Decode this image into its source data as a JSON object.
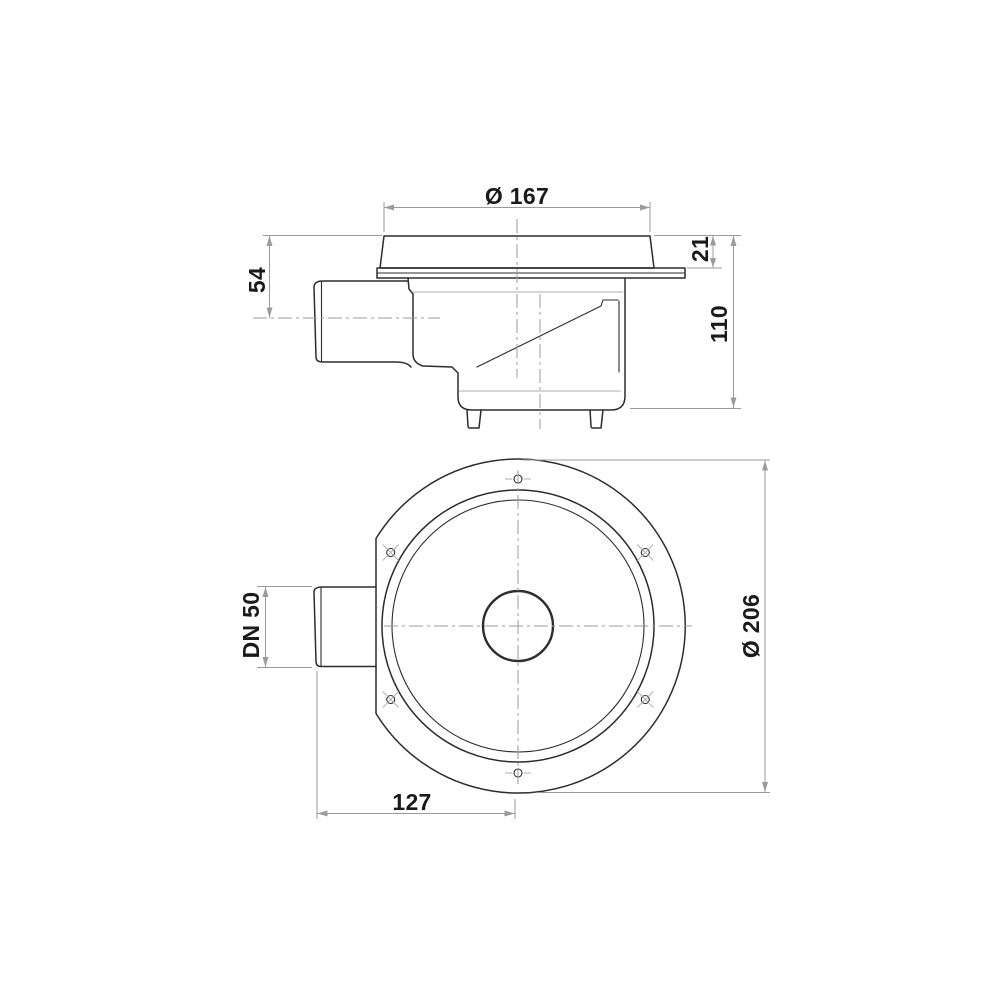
{
  "drawing": {
    "kind": "floor-drain technical drawing, two orthographic views",
    "side_view": {
      "dims": {
        "grate_diameter": "Ø 167",
        "flange_height": "21",
        "inlet_center_depth": "54",
        "total_height": "110"
      }
    },
    "top_view": {
      "dims": {
        "inlet_nominal": "DN 50",
        "flange_diameter": "Ø 206",
        "inlet_end_to_center": "127"
      }
    }
  },
  "colors": {
    "bg": "#ffffff",
    "outline": "#2d2d2d",
    "dimline": "#9b9b9b",
    "faint": "#adadad",
    "dimtext": "#1a1a1a"
  }
}
